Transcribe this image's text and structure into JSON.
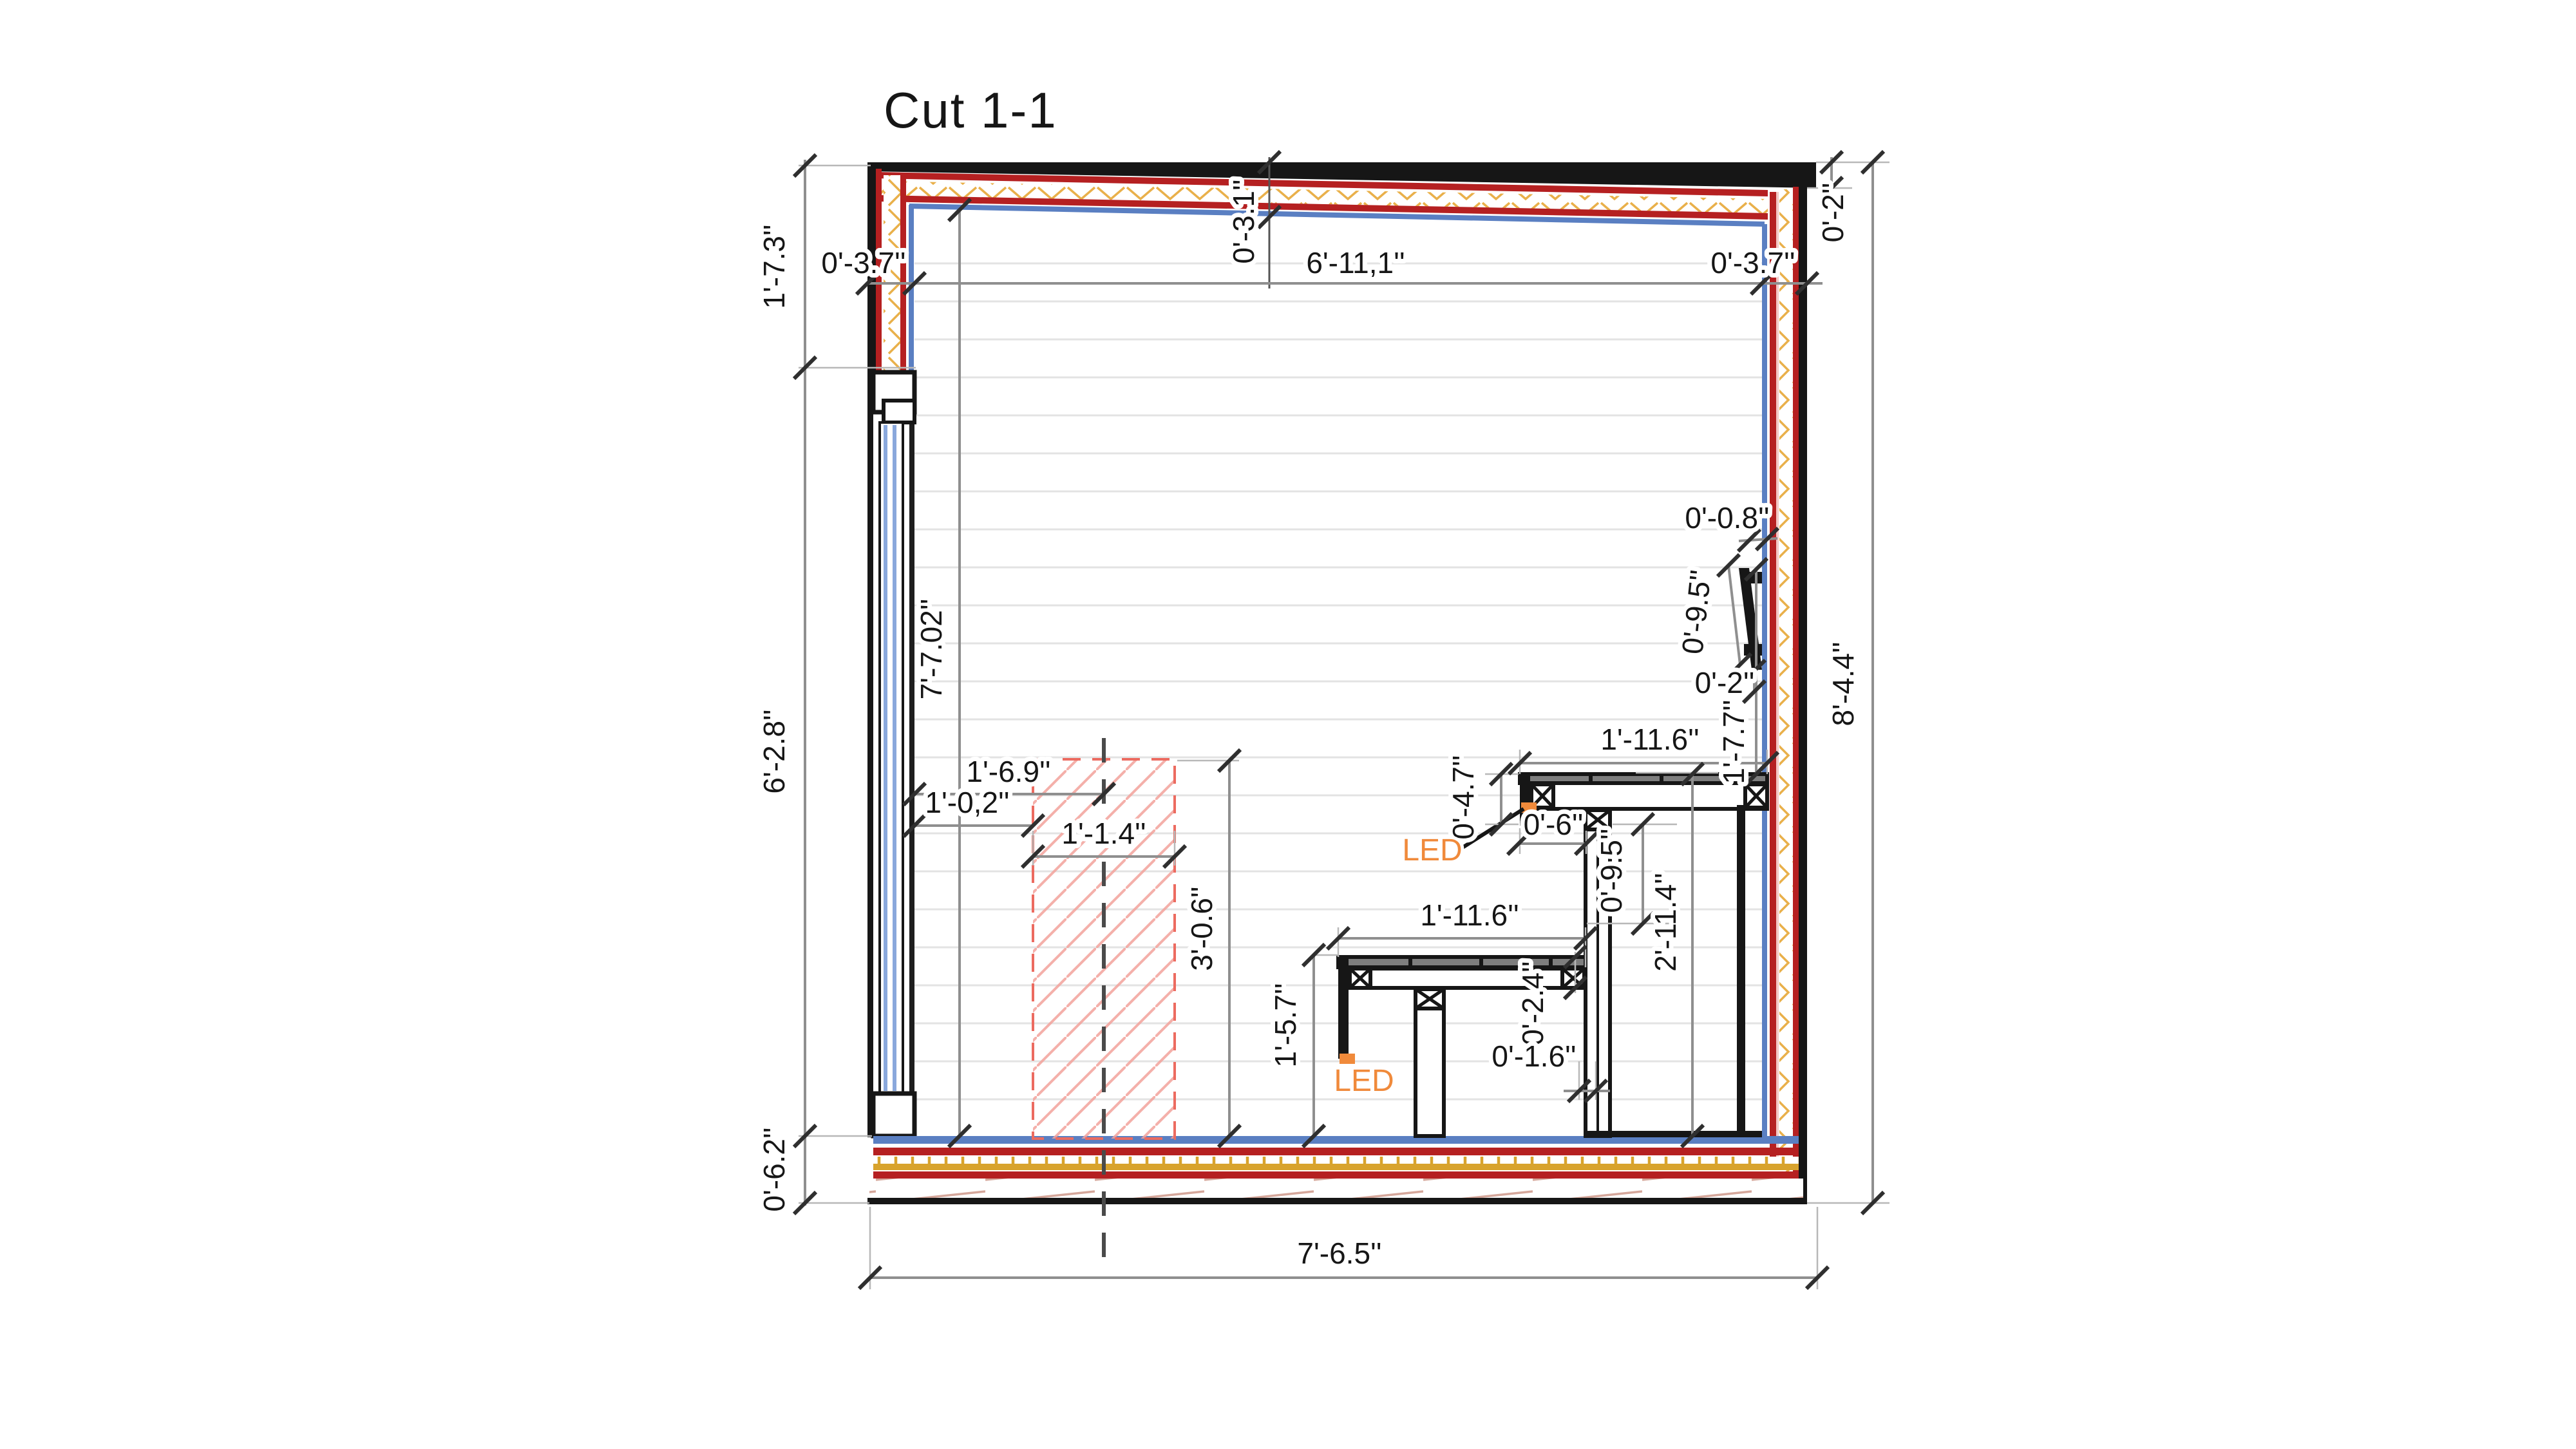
{
  "title": "Cut 1-1",
  "colors": {
    "wall_red": "#b52021",
    "insulation_gold": "#d8a32d",
    "interior_blue": "#5a7fc2",
    "outline_black": "#161616",
    "dim_line_gray": "#8f8f8f",
    "led_orange": "#f08a3b",
    "heater_hatch_red": "#ec6b60",
    "panel_line_gray": "#e3e3e3"
  },
  "dimensions": {
    "ceiling_span": "6'-11,1''",
    "wall_thickness_left": "0'-3.7''",
    "wall_thickness_right": "0'-3.7''",
    "ceiling_thickness": "0'-3.1''",
    "roof_edge_right": "0'-2''",
    "left_upper": "1'-7.3''",
    "left_glass": "6'-2.8''",
    "floor_thickness": "0'-6.2''",
    "interior_height": "7'-7.02''",
    "total_height": "8'-4.4''",
    "total_width": "7'-6.5''",
    "heater_center_offset": "1'-6.9''",
    "heater_side_offset": "1'-0,2''",
    "heater_width": "1'-1.4''",
    "heater_height": "3'-0.6''",
    "bench_lower_height": "1'-5.7''",
    "bench_lower_depth": "1'-11.6''",
    "bench_upper_depth": "1'-11.6''",
    "bench_upper_thickness": "0'-4.7''",
    "bench_upper_overhang": "0'-6''",
    "bench_step_height": "0'-9.5''",
    "bench_upper_height": "2'-11.4''",
    "bench_plank_thickness": "0'-2.4''",
    "bench_leg_thickness": "0'-1.6''",
    "backrest_top_gap": "0'-0.8''",
    "backrest_length": "0'-9.5''",
    "backrest_bottom_gap": "0'-2''",
    "backrest_to_bench": "1'-7.7''"
  },
  "annotations": {
    "led_upper": "LED",
    "led_lower": "LED"
  }
}
